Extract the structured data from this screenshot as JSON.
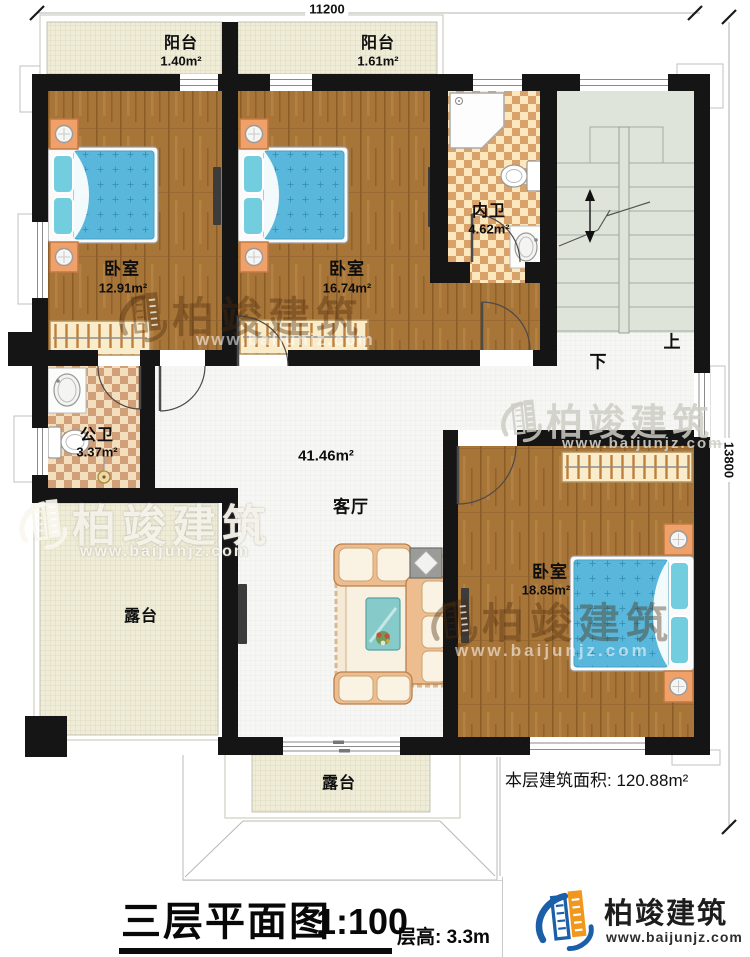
{
  "dimensions": {
    "top": "11200",
    "right": "13800"
  },
  "rooms": {
    "balcony1": {
      "label": "阳台",
      "area": "1.40m²"
    },
    "balcony2": {
      "label": "阳台",
      "area": "1.61m²"
    },
    "bedroom1": {
      "label": "卧室",
      "area": "12.91m²"
    },
    "bedroom2": {
      "label": "卧室",
      "area": "16.74m²"
    },
    "bedroom3": {
      "label": "卧室",
      "area": "18.85m²"
    },
    "inner_bath": {
      "label": "内卫",
      "area": "4.62m²"
    },
    "public_bath": {
      "label": "公卫",
      "area": "3.37m²"
    },
    "living": {
      "label": "客厅",
      "area": "41.46m²"
    },
    "terrace_left": {
      "label": "露台"
    },
    "terrace_bottom": {
      "label": "露台"
    }
  },
  "stairs": {
    "up": "上",
    "down": "下"
  },
  "notes": {
    "floor_area": "本层建筑面积: 120.88m²"
  },
  "footer": {
    "title": "三层平面图",
    "scale": "1:100",
    "floor_height": "层高: 3.3m"
  },
  "brand": {
    "name": "柏竣建筑",
    "website": "www.baijunjz.com"
  },
  "colors": {
    "wall": "#151515",
    "wood": "#a87539",
    "tile": "#f6f6f4",
    "checker_dark": "#d9a26b",
    "terrace": "#efecd8",
    "stairs": "#dee4d9",
    "bedding": "#58b7da",
    "logo_blue": "#1b5fa9",
    "logo_orange": "#f0971c"
  }
}
